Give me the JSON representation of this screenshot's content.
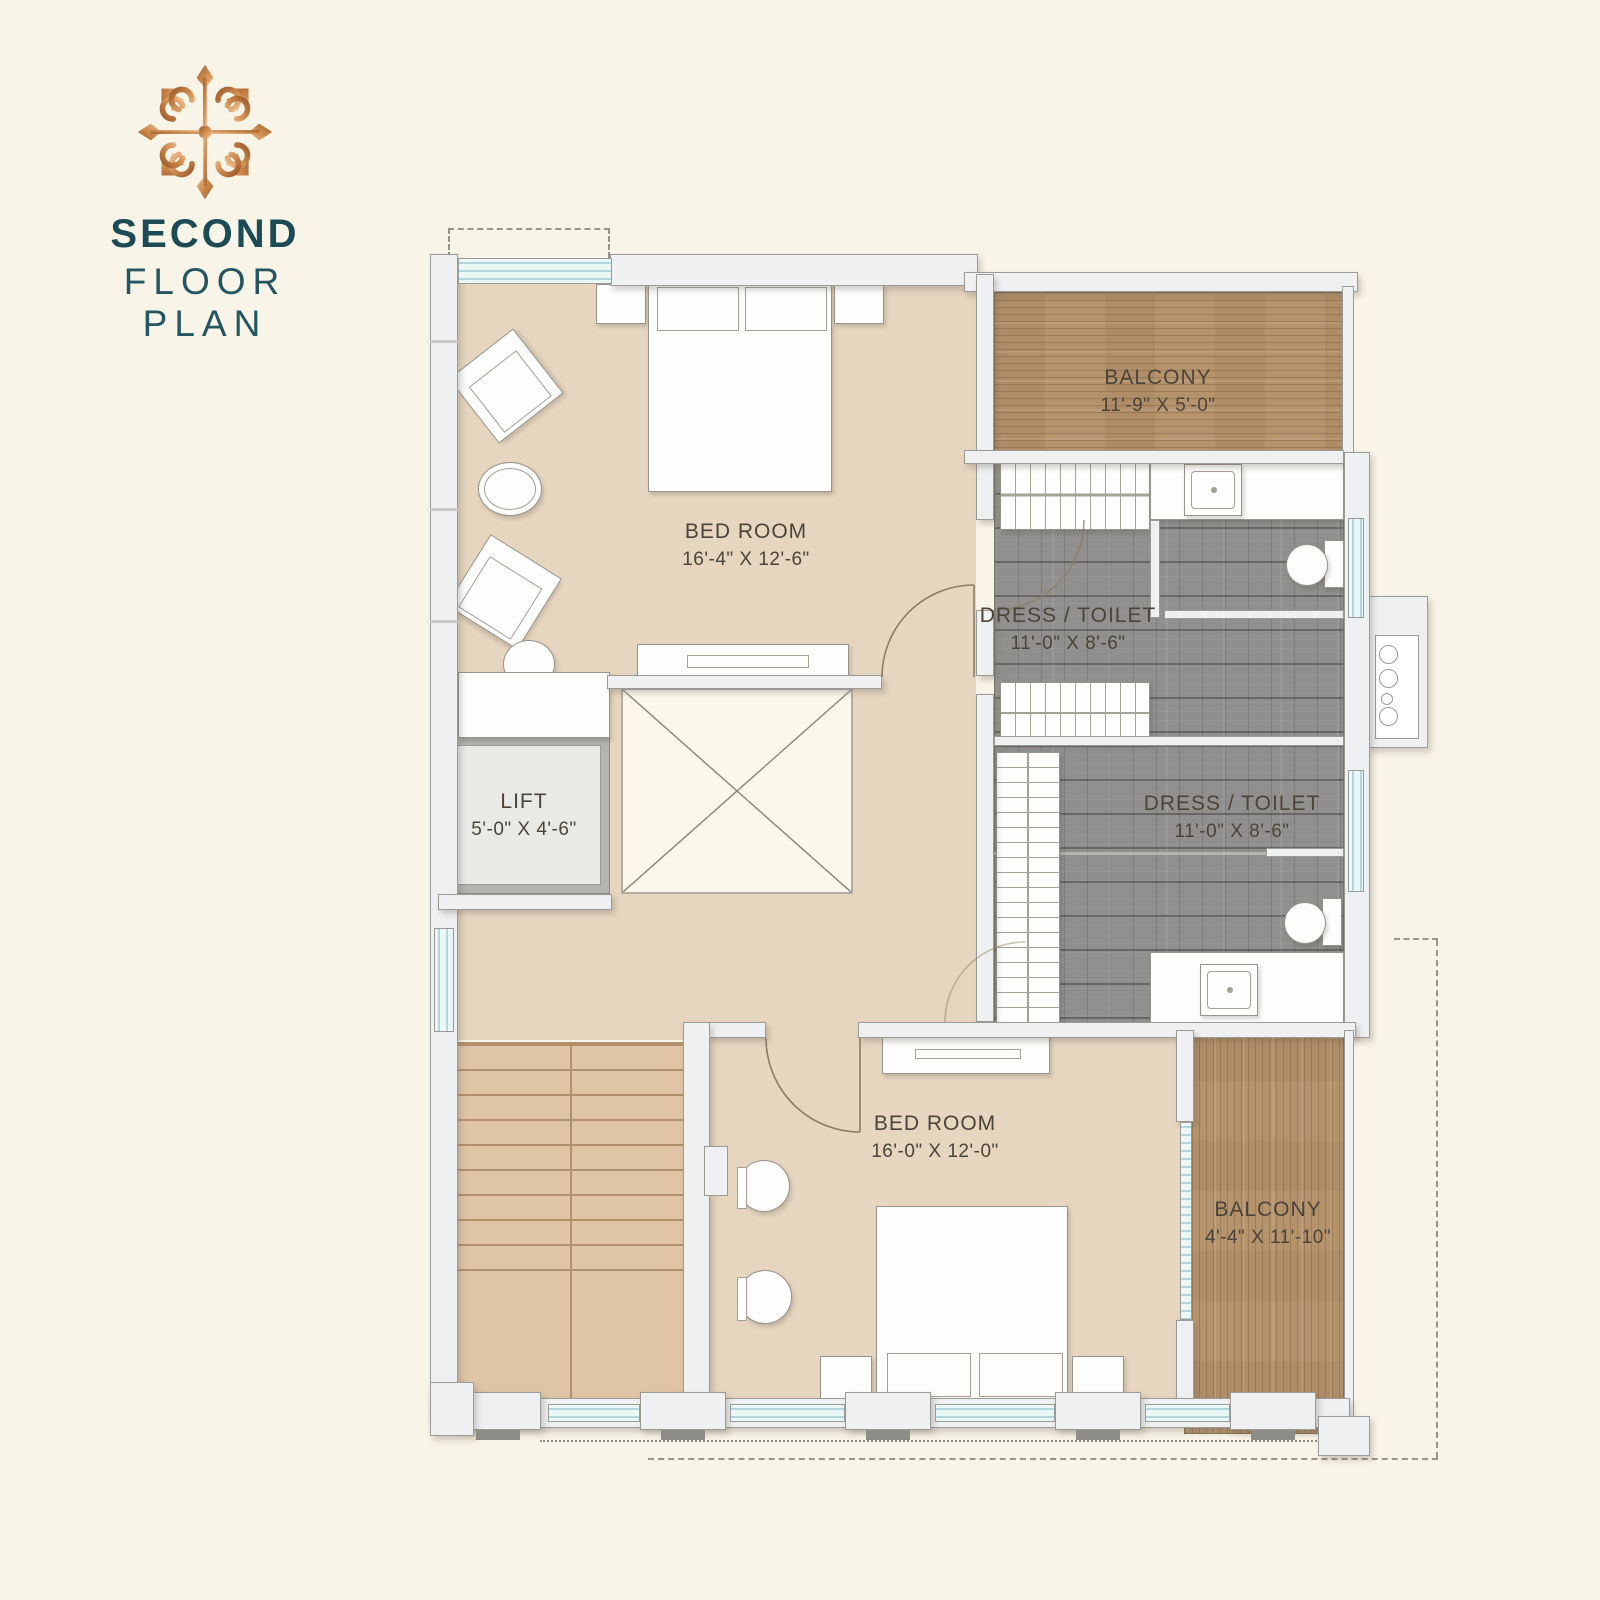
{
  "header": {
    "title_line1": "SECOND",
    "title_line2": "FLOOR PLAN",
    "logo_icon": "ornament-medallion"
  },
  "rooms": {
    "bedroom1": {
      "name": "BED ROOM",
      "dims": "16'-4\" X 12'-6\""
    },
    "balcony1": {
      "name": "BALCONY",
      "dims": "11'-9\" X 5'-0\""
    },
    "dress_toilet1": {
      "name": "DRESS / TOILET",
      "dims": "11'-0\" X 8'-6\""
    },
    "dress_toilet2": {
      "name": "DRESS / TOILET",
      "dims": "11'-0\" X 8'-6\""
    },
    "lift": {
      "name": "LIFT",
      "dims": "5'-0\" X 4'-6\""
    },
    "bedroom2": {
      "name": "BED ROOM",
      "dims": "16'-0\" X 12'-0\""
    },
    "balcony2": {
      "name": "BALCONY",
      "dims": "4'-4\" X 11'-10\""
    }
  },
  "colors": {
    "background": "#f8f4e7",
    "title_teal": "#1d4b55",
    "logo_copper": "#c5803f",
    "floor_beige": "#e6d6c0",
    "stair_tan": "#dfc4a6",
    "balcony_wood": "#b5936d",
    "toilet_tile_gray": "#908f8d",
    "wall_white": "#eef0f2",
    "label_text": "#4b443a"
  }
}
